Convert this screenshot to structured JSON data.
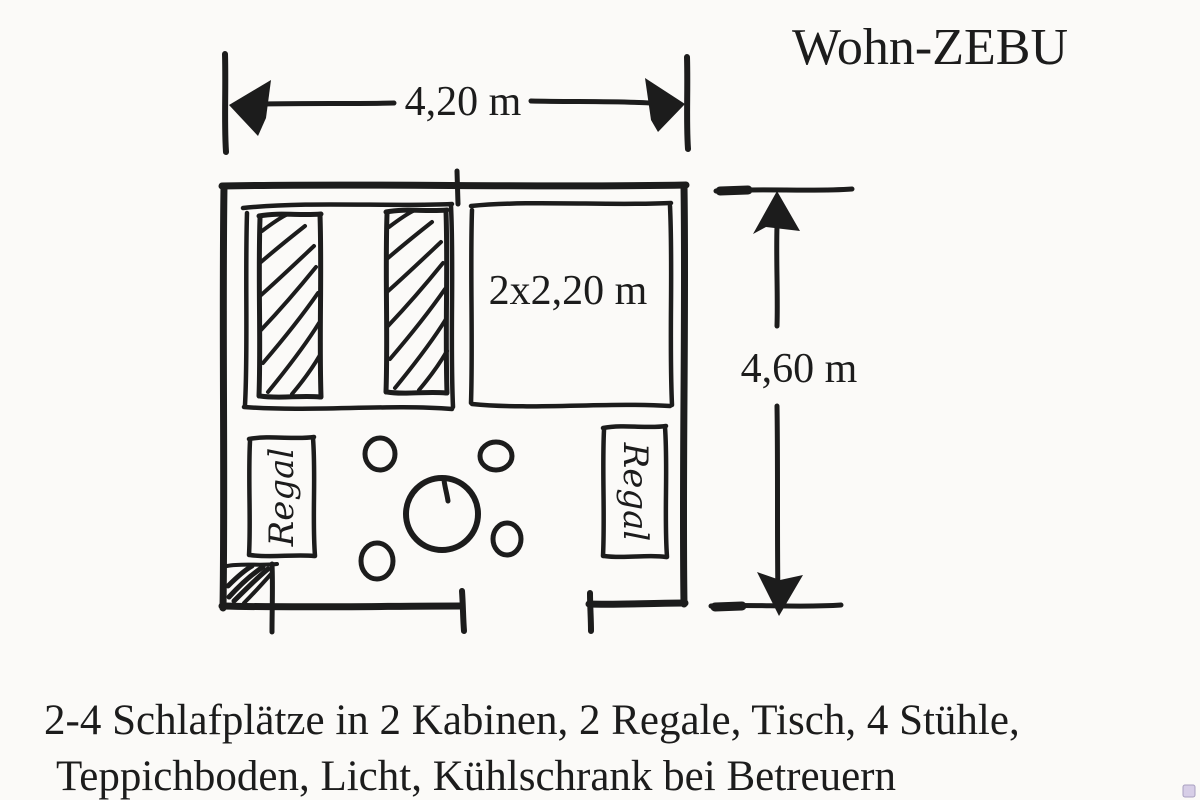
{
  "colors": {
    "ink": "#1c1c1c",
    "paper": "#fbfaf8",
    "watermark_fill": "#d7cee7",
    "watermark_border": "#a9a0c0"
  },
  "title": "Wohn-ZEBU",
  "labels": {
    "width": "4,20 m",
    "height": "4,60 m",
    "cabin_area": "2x2,20 m",
    "shelf_left": "Regal",
    "shelf_right": "Regal"
  },
  "caption": {
    "line1": "2-4 Schlafplätze in 2 Kabinen, 2 Regale, Tisch, 4 Stühle,",
    "line2": "Teppichboden, Licht, Kühlschrank bei Betreuern"
  }
}
